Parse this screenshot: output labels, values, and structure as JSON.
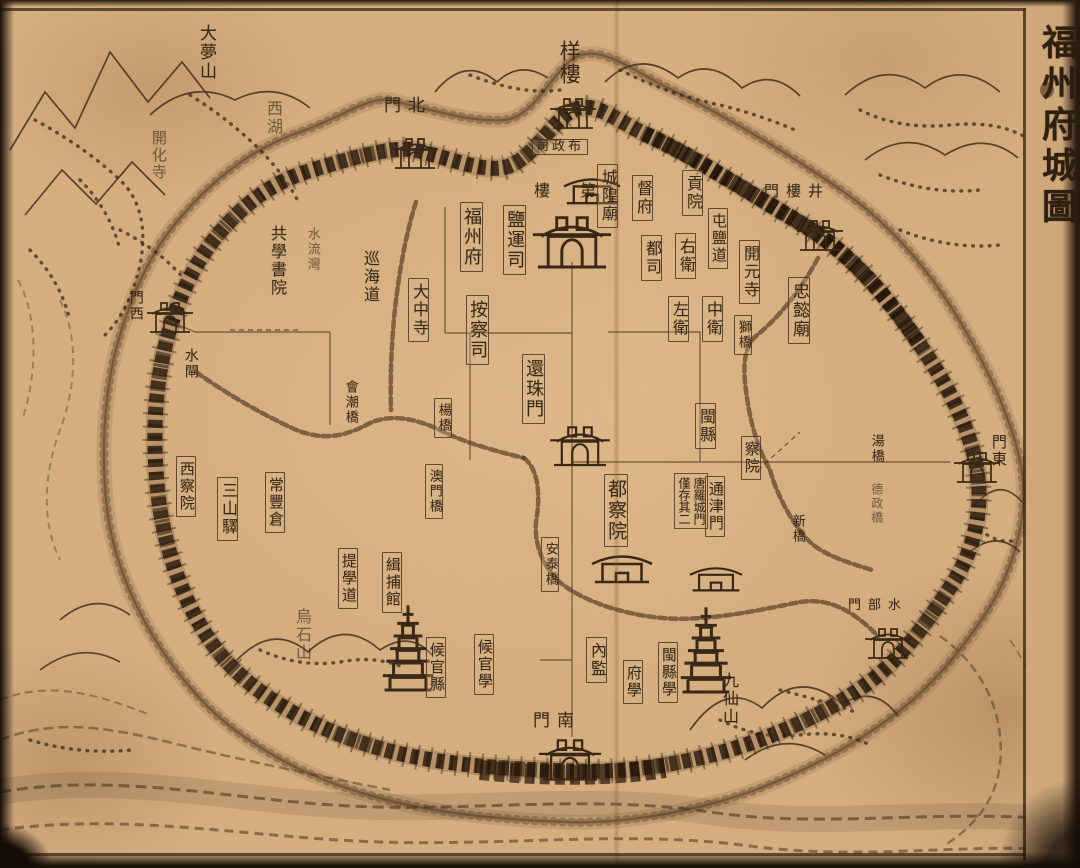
{
  "page": {
    "title": "福州府城圖",
    "paper_color": "#d5ae80",
    "ink_color": "#392a18",
    "note_text": "唐羅城門僅存其二"
  },
  "labels": [
    {
      "id": "label-dameng-hill",
      "text": "大夢山",
      "display": "大夢山",
      "x": 197,
      "y": 24,
      "fs": 17,
      "kind": "v"
    },
    {
      "id": "label-west-lake",
      "text": "西湖",
      "display": "西湖",
      "x": 264,
      "y": 100,
      "fs": 16,
      "kind": "v dim"
    },
    {
      "id": "label-kaihua-temple",
      "text": "開化寺",
      "display": "開化寺",
      "x": 150,
      "y": 130,
      "fs": 15,
      "kind": "v dim"
    },
    {
      "id": "label-wushi-hill",
      "text": "烏石山",
      "display": "烏石山",
      "x": 293,
      "y": 608,
      "fs": 16,
      "kind": "v dim"
    },
    {
      "id": "label-jiuxian-hill",
      "text": "九仙山",
      "display": "九仙山",
      "x": 720,
      "y": 672,
      "fs": 16,
      "kind": "v"
    },
    {
      "id": "label-north-gate",
      "text": "北門",
      "display": "門北",
      "x": 384,
      "y": 97,
      "fs": 17,
      "kind": "h"
    },
    {
      "id": "label-jinglou-gate",
      "text": "井樓門",
      "display": "門樓井",
      "x": 764,
      "y": 184,
      "fs": 15,
      "kind": "h"
    },
    {
      "id": "label-east-gate",
      "text": "東門",
      "display": "門東",
      "x": 990,
      "y": 434,
      "fs": 15,
      "kind": "v"
    },
    {
      "id": "label-shuibu-gate",
      "text": "水部門",
      "display": "門部水",
      "x": 848,
      "y": 599,
      "fs": 13,
      "kind": "h"
    },
    {
      "id": "label-south-gate",
      "text": "南門",
      "display": "門南",
      "x": 533,
      "y": 712,
      "fs": 17,
      "kind": "h"
    },
    {
      "id": "label-west-gate",
      "text": "西門",
      "display": "門西",
      "x": 128,
      "y": 290,
      "fs": 14,
      "kind": "v"
    },
    {
      "id": "label-water-sluice",
      "text": "水閘",
      "display": "水閘",
      "x": 183,
      "y": 348,
      "fs": 14,
      "kind": "v"
    },
    {
      "id": "label-huanzhu-gate",
      "text": "還珠門",
      "display": "還珠門",
      "x": 522,
      "y": 354,
      "fs": 18,
      "kind": "vb"
    },
    {
      "id": "label-yanglou-tower",
      "text": "样樓",
      "display": "样樓",
      "x": 558,
      "y": 40,
      "fs": 21,
      "kind": "v"
    },
    {
      "id": "label-buzhengsi",
      "text": "布政司",
      "display": "司政布",
      "x": 532,
      "y": 139,
      "fs": 13,
      "kind": "hb"
    },
    {
      "id": "label-chenghuang-temple",
      "text": "城隍廟",
      "display": "城隍廟",
      "x": 597,
      "y": 164,
      "fs": 16,
      "kind": "vb"
    },
    {
      "id": "label-dufu",
      "text": "督府",
      "display": "督府",
      "x": 632,
      "y": 175,
      "fs": 16,
      "kind": "vb"
    },
    {
      "id": "label-gongyuan",
      "text": "貢院",
      "display": "貢院",
      "x": 682,
      "y": 170,
      "fs": 16,
      "kind": "vb"
    },
    {
      "id": "label-diyilou",
      "text": "第一樓",
      "display": "樓　第",
      "x": 534,
      "y": 183,
      "fs": 16,
      "kind": "h"
    },
    {
      "id": "label-fuzhou-fu",
      "text": "福州府",
      "display": "福州府",
      "x": 460,
      "y": 202,
      "fs": 18,
      "kind": "vb"
    },
    {
      "id": "label-yanyunsi",
      "text": "鹽運司",
      "display": "鹽運司",
      "x": 503,
      "y": 205,
      "fs": 18,
      "kind": "vb"
    },
    {
      "id": "label-xunhai-circuit",
      "text": "巡海道",
      "display": "巡海道",
      "x": 361,
      "y": 250,
      "fs": 16,
      "kind": "v"
    },
    {
      "id": "label-dazhong-temple",
      "text": "大中寺",
      "display": "大中寺",
      "x": 408,
      "y": 278,
      "fs": 16,
      "kind": "vb"
    },
    {
      "id": "label-anchasi",
      "text": "按察司",
      "display": "按察司",
      "x": 466,
      "y": 295,
      "fs": 18,
      "kind": "vb"
    },
    {
      "id": "label-dusi",
      "text": "都司",
      "display": "都司",
      "x": 641,
      "y": 235,
      "fs": 16,
      "kind": "vb"
    },
    {
      "id": "label-right-guard",
      "text": "右衛",
      "display": "右衛",
      "x": 675,
      "y": 233,
      "fs": 16,
      "kind": "vb"
    },
    {
      "id": "label-tunyan-circuit",
      "text": "屯鹽道",
      "display": "屯鹽道",
      "x": 708,
      "y": 208,
      "fs": 15,
      "kind": "vb"
    },
    {
      "id": "label-kaiyuan-temple",
      "text": "開元寺",
      "display": "開元寺",
      "x": 739,
      "y": 240,
      "fs": 16,
      "kind": "vb"
    },
    {
      "id": "label-left-guard",
      "text": "左衛",
      "display": "左衛",
      "x": 668,
      "y": 296,
      "fs": 16,
      "kind": "vb"
    },
    {
      "id": "label-center-guard",
      "text": "中衛",
      "display": "中衛",
      "x": 702,
      "y": 296,
      "fs": 16,
      "kind": "vb"
    },
    {
      "id": "label-shi-bridge",
      "text": "獅橋",
      "display": "獅橋",
      "x": 734,
      "y": 315,
      "fs": 13,
      "kind": "vb"
    },
    {
      "id": "label-zhongyi-temple",
      "text": "忠懿廟",
      "display": "忠懿廟",
      "x": 788,
      "y": 277,
      "fs": 17,
      "kind": "vb"
    },
    {
      "id": "label-hechao-bridge",
      "text": "會潮橋",
      "display": "會潮橋",
      "x": 343,
      "y": 380,
      "fs": 13,
      "kind": "v"
    },
    {
      "id": "label-yang-bridge",
      "text": "楊橋",
      "display": "楊橋",
      "x": 434,
      "y": 398,
      "fs": 13,
      "kind": "vb"
    },
    {
      "id": "label-aomen-bridge",
      "text": "澳門橋",
      "display": "澳門橋",
      "x": 425,
      "y": 464,
      "fs": 13,
      "kind": "vb"
    },
    {
      "id": "label-shuiliuwan",
      "text": "水流灣",
      "display": "水流灣",
      "x": 305,
      "y": 227,
      "fs": 13,
      "kind": "v dim"
    },
    {
      "id": "label-gongxue-academy",
      "text": "共學書院",
      "display": "共學書院",
      "x": 268,
      "y": 225,
      "fs": 16,
      "kind": "v"
    },
    {
      "id": "label-min-county",
      "text": "閩縣",
      "display": "閩縣",
      "x": 695,
      "y": 403,
      "fs": 16,
      "kind": "vb"
    },
    {
      "id": "label-chayuan",
      "text": "察院",
      "display": "察院",
      "x": 741,
      "y": 436,
      "fs": 15,
      "kind": "vb"
    },
    {
      "id": "label-tongjin-gate",
      "text": "通津門",
      "display": "通津門",
      "x": 705,
      "y": 476,
      "fs": 15,
      "kind": "vb"
    },
    {
      "id": "label-tang-luocheng-note",
      "text": "唐羅城門僅存其二",
      "display": "唐羅城門\n僅存其二",
      "x": 674,
      "y": 473,
      "fs": 12,
      "kind": "note"
    },
    {
      "id": "label-duchayuan",
      "text": "都察院",
      "display": "都察院",
      "x": 604,
      "y": 474,
      "fs": 19,
      "kind": "vb"
    },
    {
      "id": "label-new-bridge",
      "text": "新橋",
      "display": "新橋",
      "x": 790,
      "y": 514,
      "fs": 13,
      "kind": "v"
    },
    {
      "id": "label-tang-bridge",
      "text": "湯橋",
      "display": "湯橋",
      "x": 869,
      "y": 434,
      "fs": 13,
      "kind": "v"
    },
    {
      "id": "label-dezheng-bridge",
      "text": "德政橋",
      "display": "德政橋",
      "x": 870,
      "y": 483,
      "fs": 12,
      "kind": "v dim"
    },
    {
      "id": "label-antai-bridge",
      "text": "安泰橋",
      "display": "安泰橋",
      "x": 541,
      "y": 537,
      "fs": 13,
      "kind": "vb"
    },
    {
      "id": "label-jibu-guan",
      "text": "緝捕館",
      "display": "緝捕館",
      "x": 382,
      "y": 552,
      "fs": 15,
      "kind": "vb"
    },
    {
      "id": "label-tixue-circuit",
      "text": "提學道",
      "display": "提學道",
      "x": 338,
      "y": 548,
      "fs": 15,
      "kind": "vb"
    },
    {
      "id": "label-changfeng-granary",
      "text": "常豐倉",
      "display": "常豐倉",
      "x": 265,
      "y": 472,
      "fs": 15,
      "kind": "vb"
    },
    {
      "id": "label-sanshan-post",
      "text": "三山驛",
      "display": "三山驛",
      "x": 217,
      "y": 477,
      "fs": 16,
      "kind": "vb"
    },
    {
      "id": "label-west-chayuan",
      "text": "西察院",
      "display": "西察院",
      "x": 176,
      "y": 456,
      "fs": 15,
      "kind": "vb"
    },
    {
      "id": "label-houguan-county",
      "text": "候官縣",
      "display": "候官縣",
      "x": 426,
      "y": 637,
      "fs": 15,
      "kind": "vb"
    },
    {
      "id": "label-houguan-school",
      "text": "候官學",
      "display": "候官學",
      "x": 474,
      "y": 634,
      "fs": 15,
      "kind": "vb"
    },
    {
      "id": "label-neijian",
      "text": "內監",
      "display": "內監",
      "x": 586,
      "y": 637,
      "fs": 16,
      "kind": "vb"
    },
    {
      "id": "label-fu-school",
      "text": "府學",
      "display": "府學",
      "x": 623,
      "y": 660,
      "fs": 15,
      "kind": "vb"
    },
    {
      "id": "label-min-county-school",
      "text": "閩縣學",
      "display": "閩縣學",
      "x": 658,
      "y": 642,
      "fs": 15,
      "kind": "vb"
    }
  ]
}
